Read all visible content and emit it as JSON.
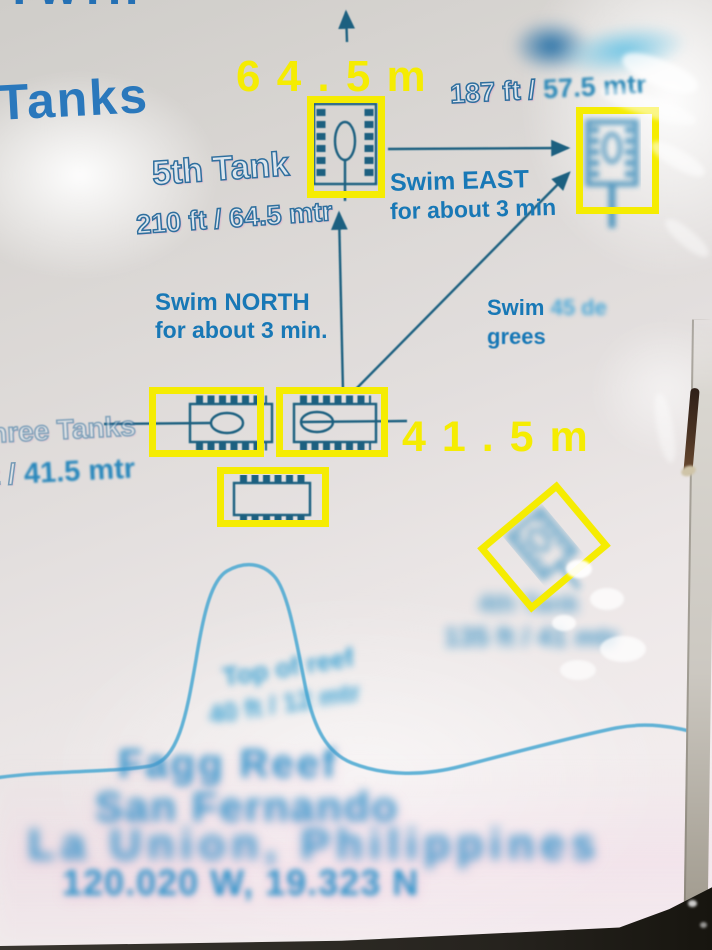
{
  "colors": {
    "annotation_yellow": "#f5ec02",
    "map_blue": "#1878b6",
    "line_teal": "#1d6080",
    "smudge_cyan": "#38a0d2",
    "sign_background": "#dcd8d6"
  },
  "top": {
    "clipped_word": "Twin",
    "title": "Tanks"
  },
  "overlay": {
    "depth_645": "6 4 . 5 m",
    "depth_415": "4 1 . 5 m"
  },
  "tank6": {
    "depth_prefix": "187 ft / ",
    "depth_smudged": "57.5 mtr"
  },
  "tank5": {
    "name": "5th Tank",
    "depth": "210 ft / 64.5 mtr"
  },
  "routes": {
    "east_line1": "Swim EAST",
    "east_line2": "for about 3 min",
    "north_line1": "Swim NORTH",
    "north_line2": "for about  3 min.",
    "deg_word": "Swim",
    "deg_smudged": "45 de",
    "deg_line2": "grees"
  },
  "three_tanks": {
    "name_partial": "hree Tanks",
    "depth_prefix": "135 ft / ",
    "depth_value": "41.5 mtr"
  },
  "tank4_smudge": {
    "line1": "4th Tank",
    "line2": "135 ft / 41 mtr"
  },
  "reef_label": {
    "line1": "Top of reef",
    "line2": "40 ft / 12 mtr"
  },
  "site": {
    "reef_name": "Fagg Reef",
    "city": "San Fernando",
    "region": "La Union, Philippines",
    "coordinates": "120.020 W,  19.323 N"
  },
  "icons": {
    "tank_icon": "tank-top-view",
    "north_arrow": "up-arrow"
  }
}
